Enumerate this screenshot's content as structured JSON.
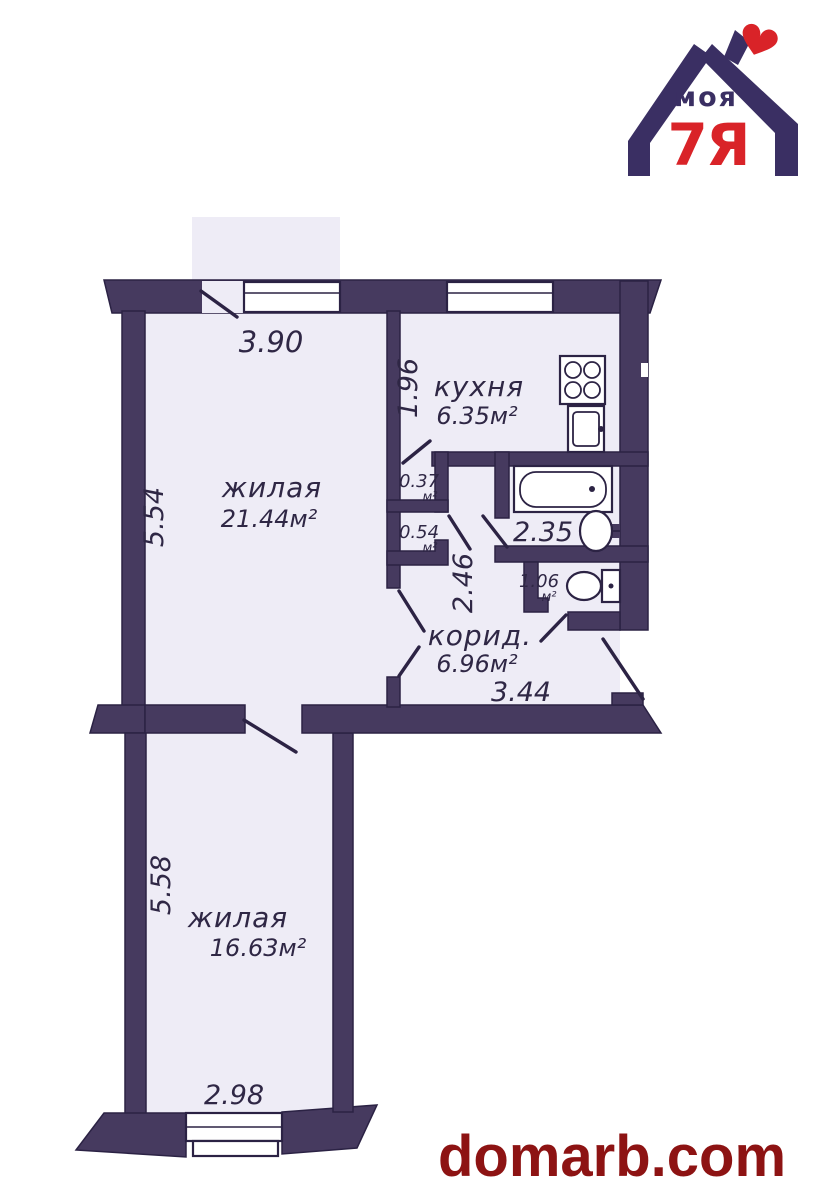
{
  "page": {
    "background": "#ffffff"
  },
  "logo": {
    "word_top": "моя",
    "word_bottom": "7Я",
    "heart_icon": "heart",
    "navy": "#3a2f63",
    "red": "#d92328"
  },
  "floor_plan": {
    "colors": {
      "wall": "#463a5f",
      "floor": "#eeecf6",
      "line": "#2c2344",
      "text": "#2f2745"
    },
    "rooms": {
      "living1": {
        "label": "жилая",
        "area": "21.44м²"
      },
      "kitchen": {
        "label": "кухня",
        "area": "6.35м²"
      },
      "closet1": {
        "value": "0.37",
        "unit": "м²"
      },
      "closet2": {
        "value": "0.54",
        "unit": "м²"
      },
      "toilet": {
        "value": "1.06",
        "unit": "м²"
      },
      "corridor": {
        "label": "корид.",
        "area": "6.96м²"
      },
      "living2": {
        "label": "жилая",
        "area": "16.63м²"
      }
    },
    "dimensions": {
      "living1_width": "3.90",
      "living1_height": "5.54",
      "kitchen_height": "1.96",
      "hall_height": "2.46",
      "bathroom_width": "2.35",
      "corridor_width": "3.44",
      "living2_height": "5.58",
      "living2_width": "2.98"
    }
  },
  "watermark": {
    "text": "domarb.com",
    "color": "#8d1313"
  }
}
